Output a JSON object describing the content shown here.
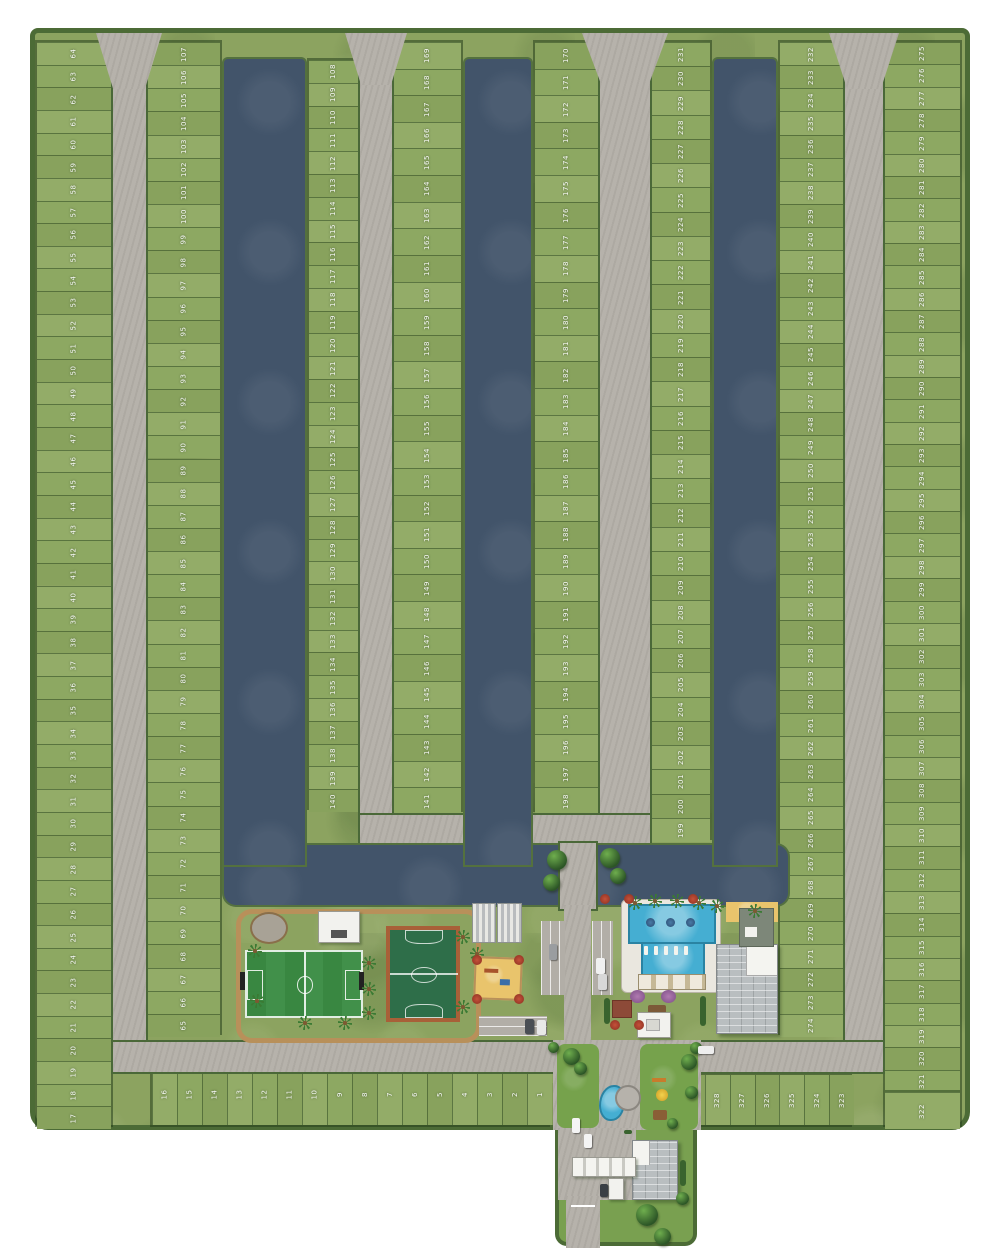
{
  "map": {
    "type": "residential-lots-master-plan",
    "lot_numbering": {
      "west_edge_column": {
        "top": 64,
        "bottom": 17
      },
      "column_2": {
        "top": 107,
        "bottom": 65
      },
      "canal1_east_column": {
        "top": 108,
        "bottom": 140
      },
      "canal2_west_column": {
        "top": 169,
        "bottom": 141
      },
      "canal2_east_column": {
        "top": 170,
        "bottom": 198
      },
      "canal3_west_column": {
        "top": 231,
        "bottom": 199
      },
      "canal3_east_column": {
        "top": 232,
        "bottom": 274
      },
      "east_edge_column": {
        "top": 275,
        "bottom": 321
      },
      "southwest_row": {
        "left": 16,
        "right": 1
      },
      "southeast_row": {
        "left": 329,
        "right": 323
      },
      "corner_lot": 322
    },
    "features": [
      "canal-1",
      "canal-2",
      "canal-3",
      "connecting-canal",
      "perimeter-road-west",
      "internal-road-2",
      "main-avenue",
      "perimeter-road-east",
      "south-road",
      "soccer-field",
      "multisport-court",
      "running-track",
      "playground-sand",
      "garden-plaza",
      "kiosk-building",
      "greenhouse-structures",
      "parking-lots",
      "swimming-pool",
      "pool-deck",
      "beach-area",
      "clubhouse",
      "cabanas",
      "flower-gardens",
      "entrance-boulevard",
      "roundabout",
      "ornamental-pond",
      "kids-playground",
      "gatehouse",
      "entry-canopy"
    ]
  },
  "colors": {
    "background": "#ffffff",
    "grass": "#8ca360",
    "site_border": "#4c6b36",
    "water": "#42546a",
    "road": "#b6b2ab",
    "soccer_green": "#398741",
    "court_green": "#2e6e49",
    "court_border_orange": "#a86038",
    "pool_blue": "#45aed2",
    "sand": "#e9c46c",
    "lot_number_text": "#ffffff"
  }
}
